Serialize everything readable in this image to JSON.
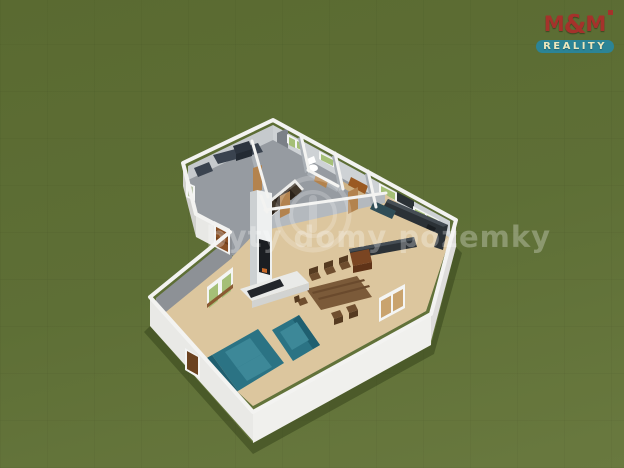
{
  "logo": {
    "m1": "M",
    "amp": "&",
    "m2": "M",
    "tagline": "REALITY"
  },
  "watermark": {
    "text": "byty domy pozemky"
  },
  "colors": {
    "grass1": "#5a6a31",
    "grass2": "#5e6f36",
    "grass3": "#69793f",
    "white": "#ffffff",
    "wallTopWhite": "#f3f3f1",
    "wallBright": "#f0f0ed",
    "wallWhite": "#e8e8e5",
    "wallWhite2": "#dedddb",
    "wallWhite3": "#e9e9e6",
    "wallShade": "#d2d2cf",
    "wallInnerL": "#c6cacd",
    "wallInnerR": "#ced2d5",
    "wallMid": "#a9afb5",
    "wallMid2": "#b4b9be",
    "wallNW": "#8d9196",
    "doorGray": "#7b8087",
    "floorGray": "#969ba1",
    "floorWood": "#dcc69e",
    "floorTan": "#cdb184",
    "shower": "#9a5a22",
    "counterDark": "#2b3136",
    "counterTop": "#454d54",
    "tealDark": "#2f4d57",
    "cabBrown": "#7a4522",
    "cabBrownDark": "#5f3318",
    "sinkDark": "#1a1e22",
    "tableBrown": "#7b5a39",
    "tableLine": "#6a4a2d",
    "chairBrown": "#6f4e2f",
    "chairDark": "#553a20",
    "sofaTeal": "#2b7384",
    "sofaLight": "#3d8898",
    "sofaDark": "#1f5f70",
    "stairDark": "#2b2219",
    "stairMid": "#40362a",
    "stairWhite": "#e9e9e7",
    "furnDark": "#3a434f",
    "furnDarker": "#2c343f",
    "furnDarkest": "#232a33",
    "fireCol": "#eef0f0",
    "fireColShade": "#ccd0d2",
    "firebox": "#1b1e22",
    "flame": "#c96a2a",
    "hearth": "#e9eae8",
    "hearthFront": "#d2d3d1",
    "tvDark": "#23262b",
    "doorTan": "#b3834e",
    "doorSlat": "#8a5126",
    "doorSlatLine": "#6e3e1b",
    "glassGreen": "#a5bf77",
    "glassPale": "#b9c4a8",
    "frameWhite": "#f4f5f4",
    "sillBrown": "#8a5a32",
    "windowTan": "#c9a36e",
    "brownDark": "#6b4220",
    "shadow": "#2f3b17",
    "logoRed": "#a5322b",
    "logoTeal": "#2c8496",
    "logoCream": "#ece7bd"
  }
}
